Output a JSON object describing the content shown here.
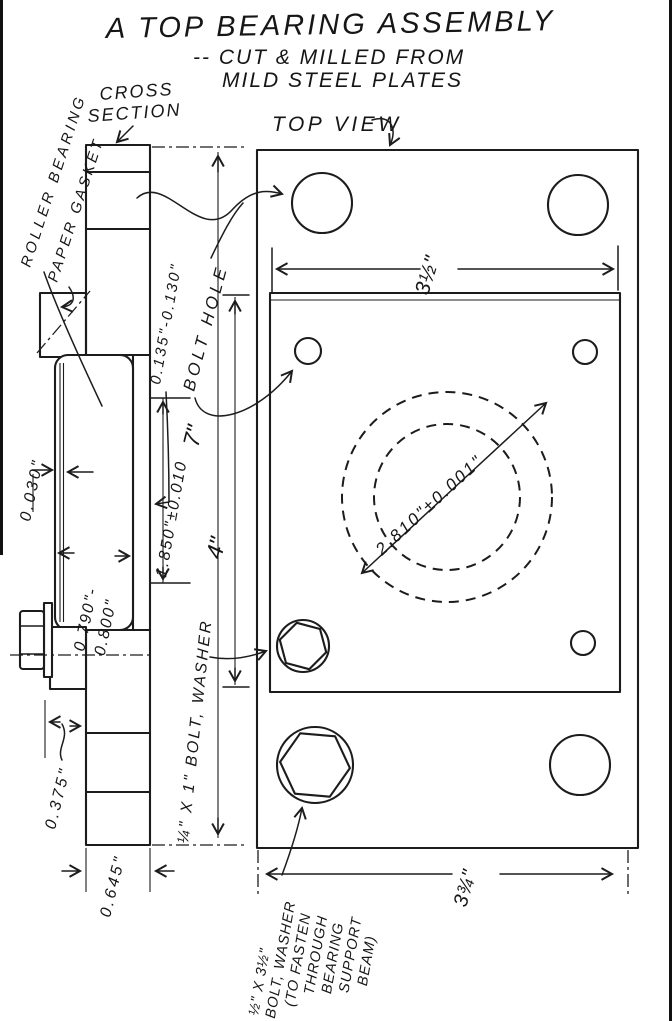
{
  "title": {
    "l1": "A TOP BEARING ASSEMBLY",
    "l2": "-- CUT & MILLED FROM",
    "l3": "MILD STEEL PLATES"
  },
  "cross": {
    "l1": "CROSS",
    "l2": "SECTION"
  },
  "top": {
    "label": "TOP VIEW"
  },
  "call": {
    "roller": "ROLLER BEARING",
    "gasket": "PAPER GASKET",
    "bolthole": "BOLT HOLE",
    "qbolt": "¼\" X 1\" BOLT, WASHER"
  },
  "note": [
    "½\" X 3½\"",
    "BOLT, WASHER",
    "(TO FASTEN",
    "THROUGH",
    "BEARING",
    "SUPPORT",
    "BEAM)"
  ],
  "dims": {
    "step": "0.135\"-0.130\"",
    "clearance": "0.030\"",
    "bore1": "0.790\"-",
    "bore2": "0.800\"",
    "depth": "1.850\"±0.010",
    "h7": "7\"",
    "v4": "4\"",
    "boss": "0.375\"",
    "thick": "0.645\"",
    "w_top": "3½\"",
    "od": "2.810\"±0.001\"",
    "w_bot": "3¾\""
  }
}
